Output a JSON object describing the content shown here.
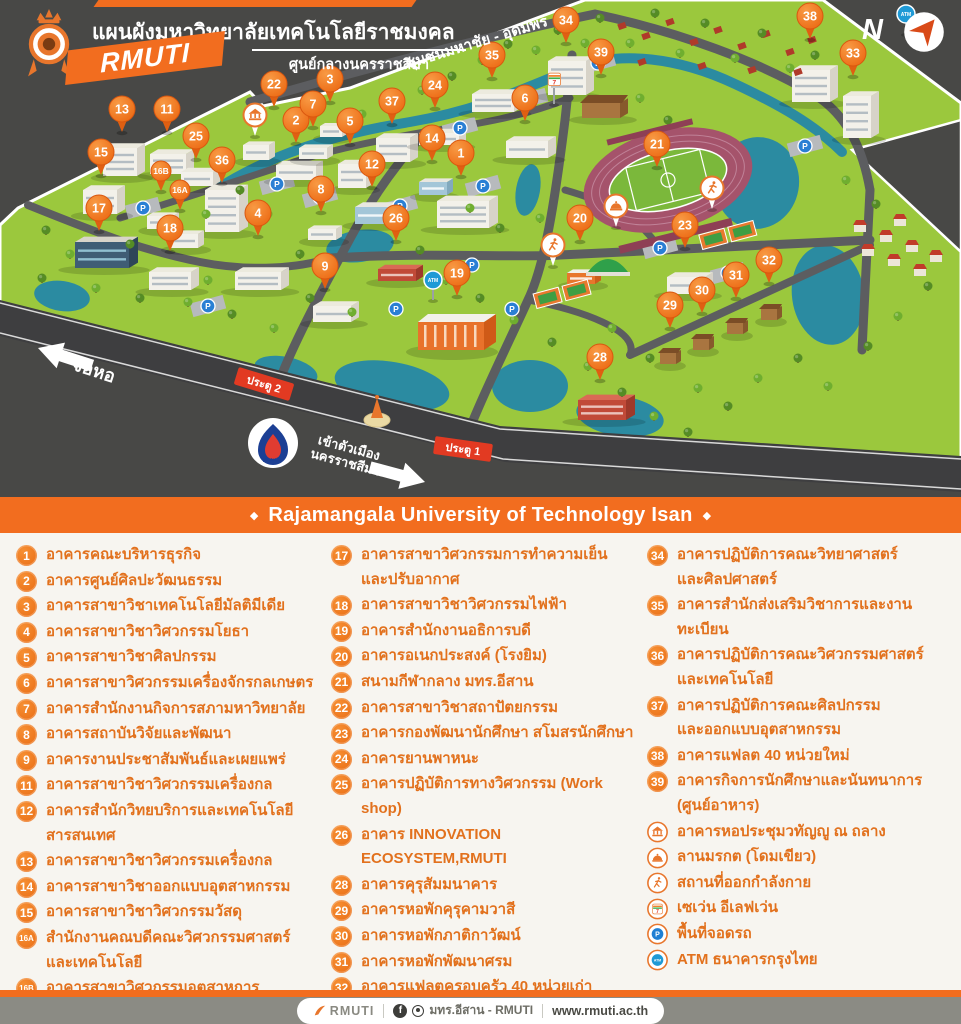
{
  "header": {
    "title": "แผนผังมหาวิทยาลัยเทคโนโลยีราชมงคลอีสาน",
    "subtitle": "ศูนย์กลางนครราชสีมา",
    "logo_text": "RMUTI",
    "compass": "N"
  },
  "banner": {
    "text": "Rajamangala University of Technology Isan",
    "bullet": "◆"
  },
  "map": {
    "road_labels": [
      {
        "text": "ชุมชนมหาชัย - อุดมพร",
        "x": 478,
        "y": 47,
        "rotate": -17,
        "size": 15
      }
    ],
    "direction_labels": [
      {
        "lines": [
          "จอหอ"
        ],
        "x": 92,
        "y": 376,
        "rotate": 18,
        "size": 18,
        "arrow": "left",
        "ax": 38,
        "ay": 348
      },
      {
        "lines": [
          "เข้าตัวเมือง",
          "นครราชสีมา"
        ],
        "x": 348,
        "y": 452,
        "rotate": 15,
        "size": 13,
        "arrow": "right",
        "ax": 425,
        "ay": 482
      }
    ],
    "gates": [
      {
        "label": "ประตู 1",
        "x": 463,
        "y": 449,
        "rotate": 8
      },
      {
        "label": "ประตู 2",
        "x": 264,
        "y": 384,
        "rotate": 17
      }
    ],
    "ptt_label": "pttstation",
    "pins": [
      {
        "n": "1",
        "x": 461,
        "y": 176
      },
      {
        "n": "2",
        "x": 296,
        "y": 143
      },
      {
        "n": "3",
        "x": 330,
        "y": 102
      },
      {
        "n": "4",
        "x": 258,
        "y": 236
      },
      {
        "n": "5",
        "x": 350,
        "y": 144
      },
      {
        "n": "6",
        "x": 525,
        "y": 121
      },
      {
        "n": "7",
        "x": 313,
        "y": 127
      },
      {
        "n": "8",
        "x": 321,
        "y": 212
      },
      {
        "n": "9",
        "x": 325,
        "y": 289
      },
      {
        "n": "11",
        "x": 167,
        "y": 132
      },
      {
        "n": "12",
        "x": 372,
        "y": 187
      },
      {
        "n": "13",
        "x": 122,
        "y": 132
      },
      {
        "n": "14",
        "x": 432,
        "y": 161
      },
      {
        "n": "15",
        "x": 101,
        "y": 175
      },
      {
        "n": "16A",
        "x": 180,
        "y": 210,
        "small": true
      },
      {
        "n": "16B",
        "x": 161,
        "y": 191,
        "small": true
      },
      {
        "n": "17",
        "x": 99,
        "y": 231
      },
      {
        "n": "18",
        "x": 170,
        "y": 251
      },
      {
        "n": "19",
        "x": 457,
        "y": 296
      },
      {
        "n": "20",
        "x": 580,
        "y": 241
      },
      {
        "n": "21",
        "x": 657,
        "y": 167
      },
      {
        "n": "22",
        "x": 274,
        "y": 107
      },
      {
        "n": "23",
        "x": 685,
        "y": 248
      },
      {
        "n": "24",
        "x": 435,
        "y": 108
      },
      {
        "n": "25",
        "x": 196,
        "y": 159
      },
      {
        "n": "26",
        "x": 396,
        "y": 241
      },
      {
        "n": "28",
        "x": 600,
        "y": 380
      },
      {
        "n": "29",
        "x": 670,
        "y": 328
      },
      {
        "n": "30",
        "x": 702,
        "y": 313
      },
      {
        "n": "31",
        "x": 736,
        "y": 298
      },
      {
        "n": "32",
        "x": 769,
        "y": 283
      },
      {
        "n": "33",
        "x": 853,
        "y": 76
      },
      {
        "n": "34",
        "x": 566,
        "y": 43
      },
      {
        "n": "35",
        "x": 492,
        "y": 78
      },
      {
        "n": "36",
        "x": 222,
        "y": 183
      },
      {
        "n": "37",
        "x": 392,
        "y": 124
      },
      {
        "n": "38",
        "x": 810,
        "y": 39
      },
      {
        "n": "39",
        "x": 601,
        "y": 75
      }
    ],
    "icon_markers": [
      {
        "type": "temple",
        "x": 255,
        "y": 136
      },
      {
        "type": "dome",
        "x": 616,
        "y": 227
      },
      {
        "type": "runner",
        "x": 712,
        "y": 209
      },
      {
        "type": "runner",
        "x": 553,
        "y": 266
      },
      {
        "type": "seven",
        "x": 554,
        "y": 104
      },
      {
        "type": "atm",
        "x": 433,
        "y": 300
      },
      {
        "type": "atm",
        "x": 906,
        "y": 34
      }
    ],
    "parking_label": "P",
    "parking_positions": [
      [
        143,
        208
      ],
      [
        208,
        306
      ],
      [
        277,
        184
      ],
      [
        320,
        197
      ],
      [
        400,
        206
      ],
      [
        460,
        128
      ],
      [
        483,
        186
      ],
      [
        530,
        99
      ],
      [
        598,
        63
      ],
      [
        805,
        146
      ],
      [
        660,
        248
      ],
      [
        728,
        273
      ],
      [
        396,
        309
      ],
      [
        472,
        265
      ],
      [
        512,
        309
      ]
    ]
  },
  "legend": {
    "columns": [
      [
        {
          "badge": "1",
          "text": "อาคารคณะบริหารธุรกิจ"
        },
        {
          "badge": "2",
          "text": "อาคารศูนย์ศิลปะวัฒนธรรม"
        },
        {
          "badge": "3",
          "text": "อาคารสาขาวิชาเทคโนโลยีมัลติมีเดีย"
        },
        {
          "badge": "4",
          "text": "อาคารสาขาวิชาวิศวกรรมโยธา"
        },
        {
          "badge": "5",
          "text": "อาคารสาขาวิชาศิลปกรรม"
        },
        {
          "badge": "6",
          "text": "อาคารสาขาวิศวกรรมเครื่องจักรกลเกษตร"
        },
        {
          "badge": "7",
          "text": "อาคารสำนักงานกิจการสภามหาวิทยาลัย"
        },
        {
          "badge": "8",
          "text": "อาคารสถาบันวิจัยและพัฒนา"
        },
        {
          "badge": "9",
          "text": "อาคารงานประชาสัมพันธ์และเผยแพร่"
        },
        {
          "badge": "11",
          "text": "อาคารสาขาวิชาวิศวกรรมเครื่องกล"
        },
        {
          "badge": "12",
          "text": "อาคารสำนักวิทยบริการและเทคโนโลยีสารสนเทศ"
        },
        {
          "badge": "13",
          "text": "อาคารสาขาวิชาวิศวกรรมเครื่องกล"
        },
        {
          "badge": "14",
          "text": "อาคารสาขาวิชาออกแบบอุตสาหกรรม"
        },
        {
          "badge": "15",
          "text": "อาคารสาขาวิชาวิศวกรรมวัสดุ"
        },
        {
          "badge": "16A",
          "text": "สำนักงานคณบดีคณะวิศวกรรมศาสตร์",
          "text2": "และเทคโนโลยี"
        },
        {
          "badge": "16B",
          "text": "อาคารสาขาวิศวกรรมอุตสาหการ"
        }
      ],
      [
        {
          "badge": "17",
          "text": "อาคารสาขาวิศวกรรมการทำความเย็น",
          "text2": "และปรับอากาศ"
        },
        {
          "badge": "18",
          "text": "อาคารสาขาวิชาวิศวกรรมไฟฟ้า"
        },
        {
          "badge": "19",
          "text": "อาคารสำนักงานอธิการบดี"
        },
        {
          "badge": "20",
          "text": "อาคารอเนกประสงค์ (โรงยิม)"
        },
        {
          "badge": "21",
          "text": "สนามกีฬากลาง มทร.อีสาน"
        },
        {
          "badge": "22",
          "text": "อาคารสาขาวิชาสถาปัตยกรรม"
        },
        {
          "badge": "23",
          "text": "อาคารกองพัฒนานักศึกษา สโมสรนักศึกษา"
        },
        {
          "badge": "24",
          "text": "อาคารยานพาหนะ"
        },
        {
          "badge": "25",
          "text": "อาคารปฏิบัติการทางวิศวกรรม (Work shop)"
        },
        {
          "badge": "26",
          "text": "อาคาร INNOVATION ECOSYSTEM,RMUTI"
        },
        {
          "badge": "28",
          "text": "อาคารคุรุสัมมนาคาร"
        },
        {
          "badge": "29",
          "text": "อาคารหอพักคุรุคามวาสี"
        },
        {
          "badge": "30",
          "text": "อาคารหอพักภาติกาวัฒน์"
        },
        {
          "badge": "31",
          "text": "อาคารหอพักพัฒนาศรม"
        },
        {
          "badge": "32",
          "text": "อาคารแฟลตครอบครัว 40 หน่วยเก่า"
        },
        {
          "badge": "33",
          "text": "อาคารหอพักนักศึกษา"
        }
      ],
      [
        {
          "badge": "34",
          "text": "อาคารปฏิบัติการคณะวิทยาศาสตร์",
          "text2": "และศิลปศาสตร์"
        },
        {
          "badge": "35",
          "text": "อาคารสำนักส่งเสริมวิชาการและงานทะเบียน"
        },
        {
          "badge": "36",
          "text": "อาคารปฏิบัติการคณะวิศวกรรมศาสตร์",
          "text2": "และเทคโนโลยี"
        },
        {
          "badge": "37",
          "text": "อาคารปฏิบัติการคณะศิลปกรรม",
          "text2": "และออกแบบอุตสาหกรรม"
        },
        {
          "badge": "38",
          "text": "อาคารแฟลต 40 หน่วยใหม่"
        },
        {
          "badge": "39",
          "text": "อาคารกิจการนักศึกษาและนันทนาการ",
          "text2": "(ศูนย์อาหาร)"
        },
        {
          "icon": "temple",
          "text": "อาคารหอประชุมวทัญญู ณ ถลาง"
        },
        {
          "icon": "dome",
          "text": "ลานมรกต (โดมเขียว)"
        },
        {
          "icon": "runner",
          "text": "สถานที่ออกกำลังกาย"
        },
        {
          "icon": "seven",
          "text": "เซเว่น อีเลฟเว่น"
        },
        {
          "icon": "parking",
          "text": "พื้นที่จอดรถ"
        },
        {
          "icon": "atm",
          "text": "ATM ธนาคารกรุงไทย"
        }
      ]
    ]
  },
  "footer": {
    "brand": "RMUTI",
    "social_text": "มทร.อีสาน - RMUTI",
    "facebook_icon_label": "f",
    "url": "www.rmuti.ac.th"
  }
}
